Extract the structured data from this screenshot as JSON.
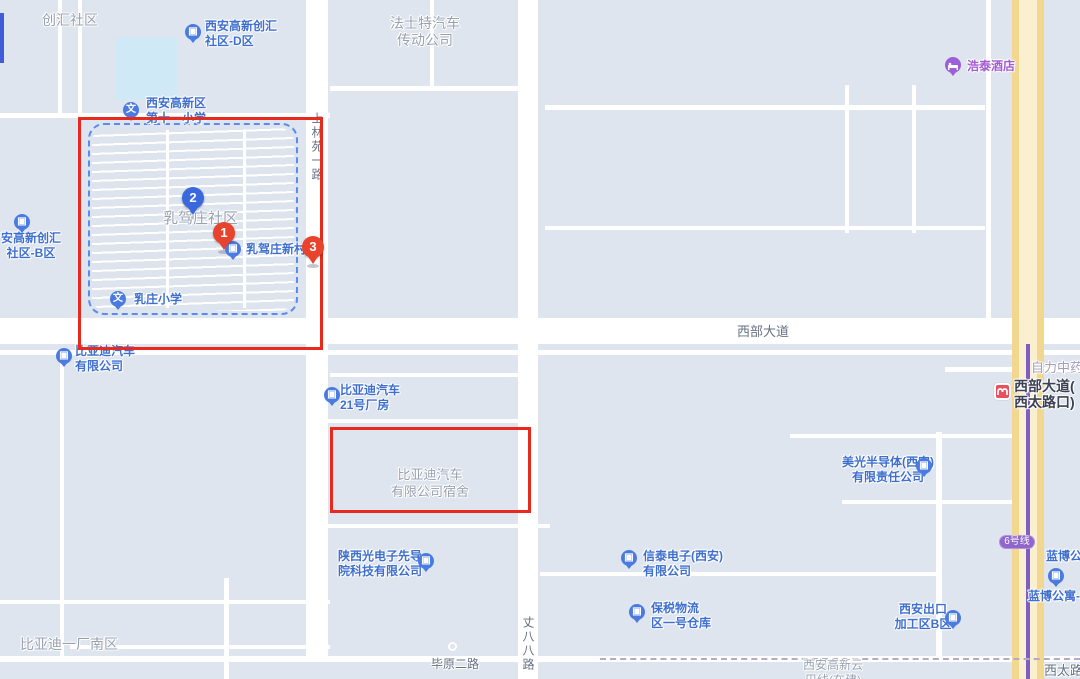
{
  "map": {
    "markers": [
      {
        "label": "1",
        "color": "red"
      },
      {
        "label": "2",
        "color": "blue"
      },
      {
        "label": "3",
        "color": "red"
      }
    ],
    "pois": [
      {
        "name": "xian-gaoxin-chuanghui-d",
        "lines": [
          "西安高新创汇",
          "社区-D区"
        ]
      },
      {
        "name": "gaoxin-no11-primary-school",
        "lines": [
          "西安高新区",
          "第十一小学"
        ]
      },
      {
        "name": "ruzhuang-primary-school",
        "lines": [
          "乳庄小学"
        ]
      },
      {
        "name": "rujiazhuang-xincun",
        "lines": [
          "乳驾庄新村"
        ]
      },
      {
        "name": "xian-gaoxin-chuanghui-b",
        "lines": [
          "安高新创汇",
          "社区-B区"
        ]
      },
      {
        "name": "byd-auto-co",
        "lines": [
          "比亚迪汽车",
          "有限公司"
        ]
      },
      {
        "name": "byd-no21-plant",
        "lines": [
          "比亚迪汽车",
          "21号厂房"
        ]
      },
      {
        "name": "shaanxi-photonics",
        "lines": [
          "陕西光电子先导",
          "院科技有限公司"
        ]
      },
      {
        "name": "xintai-electronics",
        "lines": [
          "信泰电子(西安)",
          "有限公司"
        ]
      },
      {
        "name": "bonded-logistics-warehouse",
        "lines": [
          "保税物流",
          "区一号仓库"
        ]
      },
      {
        "name": "micron-semiconductor",
        "lines": [
          "美光半导体(西安)",
          "有限责任公司"
        ]
      },
      {
        "name": "xian-export-zone-b",
        "lines": [
          "西安出口",
          "加工区B区"
        ]
      },
      {
        "name": "lanbo-apartment-b",
        "lines": [
          "蓝博公寓-B("
        ]
      },
      {
        "name": "lanbo-apartment",
        "lines": [
          "蓝博公寓"
        ]
      },
      {
        "name": "haotai-hotel",
        "lines": [
          "浩泰酒店"
        ]
      },
      {
        "name": "metro-station-xibu-dadao",
        "lines": [
          "西部大道(",
          "西太路口)"
        ]
      }
    ],
    "area_labels": [
      {
        "name": "chuanghui-shequ",
        "lines": [
          "创汇社区"
        ]
      },
      {
        "name": "fast-auto-drive",
        "lines": [
          "法士特汽车",
          "传动公司"
        ]
      },
      {
        "name": "rujiazhuang-shequ",
        "lines": [
          "乳驾庄社区"
        ]
      },
      {
        "name": "byd-dormitory",
        "lines": [
          "比亚迪汽车",
          "有限公司宿舍"
        ]
      },
      {
        "name": "byd-plant1-south",
        "lines": [
          "比亚迪一厂南区"
        ]
      },
      {
        "name": "gaoxin-yunba-line",
        "lines": [
          "西安高新云",
          "巴线(在建)"
        ]
      },
      {
        "name": "zili-zhongyao",
        "lines": [
          "自力中药"
        ]
      }
    ],
    "road_labels": [
      {
        "name": "shanglinyuan-1-road",
        "text": "上林苑一路"
      },
      {
        "name": "xibu-dadao",
        "text": "西部大道"
      },
      {
        "name": "biyuan-2-road",
        "text": "毕原二路"
      },
      {
        "name": "zhangbaba-road",
        "text": "丈八八路"
      },
      {
        "name": "xitai-road",
        "text": "西太路"
      }
    ],
    "badges": {
      "metro_line": "6号线"
    },
    "colors": {
      "annotation_red": "#e8291d",
      "marker_red": "#e8432d",
      "marker_blue": "#3a68dd",
      "poi_label_blue": "#3f6fce",
      "area_label_gray": "#98a1b1",
      "road_label_gray": "#667083",
      "hotel_purple": "#9c5fd8",
      "metro_line_purple": "#7b5fc4",
      "metro_badge_purple": "#9065cc",
      "highway_yellow": "#f2d78e",
      "block_fill": "#dee5ef"
    }
  }
}
